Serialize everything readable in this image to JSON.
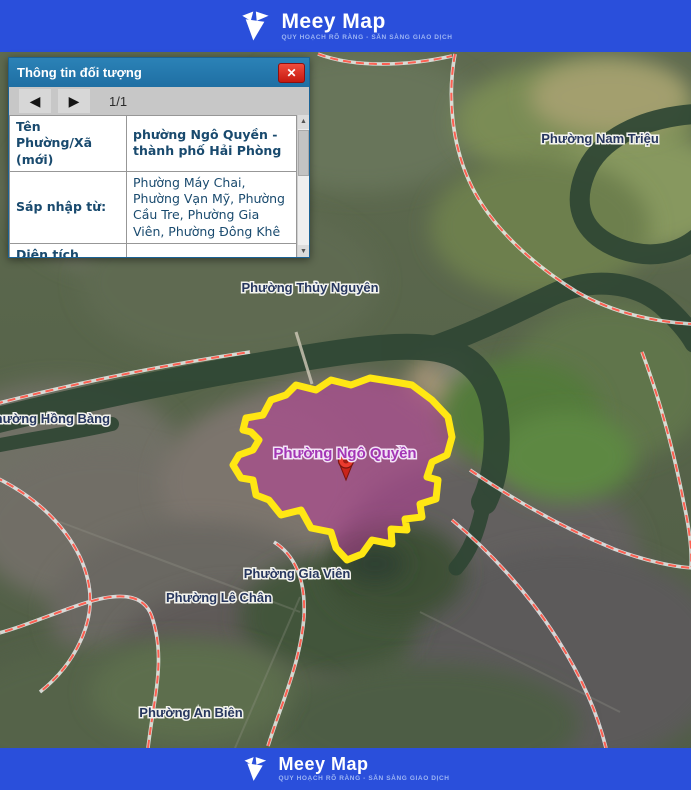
{
  "header": {
    "brand": "Meey Map",
    "tagline": "QUY HOẠCH RÕ RÀNG - SẴN SÀNG GIAO DỊCH"
  },
  "footer": {
    "brand": "Meey Map",
    "tagline": "QUY HOẠCH RÕ RÀNG - SẴN SÀNG GIAO DỊCH"
  },
  "popup": {
    "title": "Thông tin đối tượng",
    "pager": "1/1",
    "icons": {
      "close": "✕",
      "prev": "◀",
      "next": "▶",
      "scroll_up": "▲",
      "scroll_down": "▼"
    },
    "rows": [
      {
        "label": "Tên Phường/Xã (mới)",
        "value": "phường Ngô Quyền - thành phố Hải Phòng"
      },
      {
        "label": "Sáp nhập từ:",
        "value": "Phường Máy Chai, Phường Vạn Mỹ, Phường Cầu Tre, Phường Gia Viên, Phường Đông Khê"
      },
      {
        "label": "Diện tích (km²)",
        "value": "5,81"
      },
      {
        "label": "Dân số (người)",
        "value": "88.505"
      }
    ]
  },
  "map": {
    "labels": {
      "nam_trieu": "Phường Nam Triệu",
      "thuy_nguyen": "Phường Thủy Nguyên",
      "hong_bang": "Phường Hồng Bàng",
      "ngo_quyen": "Phường Ngô Quyền",
      "gia_vien": "Phường Gia Viên",
      "le_chan": "Phường Lê Chân",
      "an_bien": "Phường An Biên"
    },
    "selected_ward": "Phường Ngô Quyền"
  },
  "colors": {
    "brand_blue": "#2a4fdb",
    "popup_header_blue": "#2276ab",
    "close_red": "#d42a20",
    "boundary_red": "#ff5a4b",
    "highlight_yellow": "#ffe713",
    "highlight_pink": "#c03a9e",
    "label_navy": "#26365e",
    "label_purple": "#a335b5"
  }
}
